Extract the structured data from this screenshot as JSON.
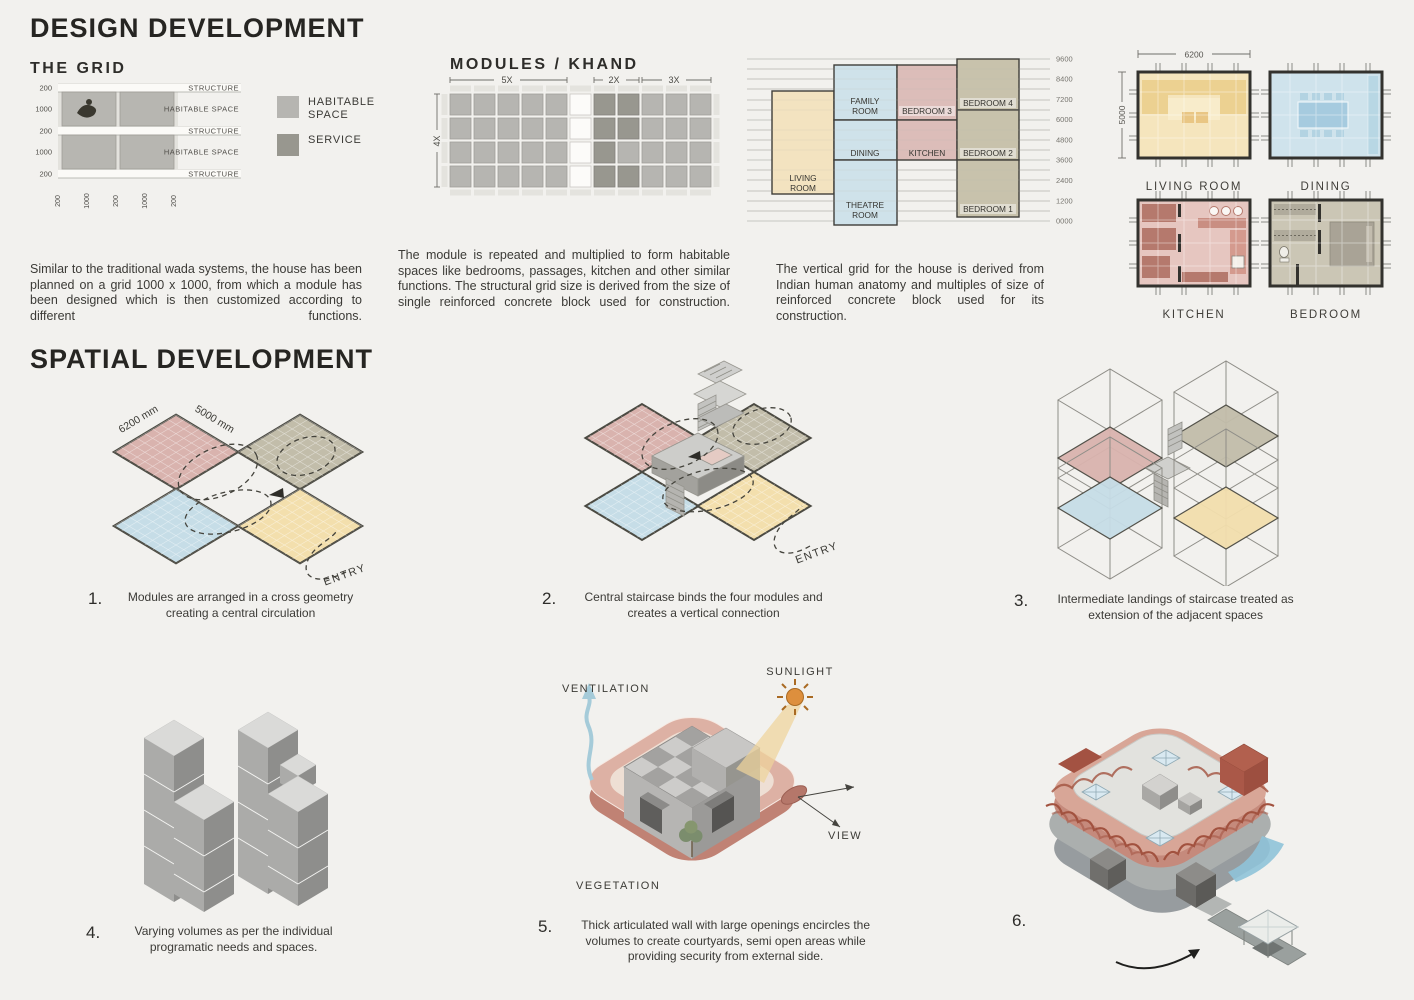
{
  "palette": {
    "module_pink": "#d9b3ae",
    "module_tan": "#c2bdaa",
    "module_blue": "#c6dde7",
    "module_yellow": "#f3dfad",
    "habitable_gray": "#b6b5b1",
    "service_gray": "#98978f",
    "wall_pink": "#d8a697",
    "section_cream": "#f3e3c0",
    "lattice_red": "#a2523f"
  },
  "header": {
    "title": "DESIGN DEVELOPMENT"
  },
  "grid": {
    "title": "THE GRID",
    "left_labels": [
      "200",
      "1000",
      "200",
      "1000",
      "200"
    ],
    "right_labels": [
      "STRUCTURE",
      "HABITABLE SPACE",
      "STRUCTURE",
      "HABITABLE SPACE",
      "STRUCTURE"
    ],
    "bottom_labels": [
      "200",
      "1000",
      "200",
      "1000",
      "200"
    ]
  },
  "legend": {
    "items": [
      {
        "label": "HABITABLE SPACE"
      },
      {
        "label": "SERVICE"
      }
    ]
  },
  "modules": {
    "title": "MODULES / KHAND",
    "dim_top": [
      "5X",
      "2X",
      "3X"
    ],
    "dim_left": "4X"
  },
  "section": {
    "scale": [
      "9600",
      "8400",
      "7200",
      "6000",
      "4800",
      "3600",
      "2400",
      "1200",
      "0000"
    ],
    "rooms": {
      "living": [
        "LIVING",
        "ROOM"
      ],
      "family": [
        "FAMILY",
        "ROOM"
      ],
      "dining": "DINING",
      "theatre": [
        "THEATRE",
        "ROOM"
      ],
      "bedroom3": "BEDROOM 3",
      "kitchen": "KITCHEN",
      "bedroom4": "BEDROOM 4",
      "bedroom2": "BEDROOM 2",
      "bedroom1": "BEDROOM 1"
    }
  },
  "plans": {
    "dim_width": "6200",
    "dim_height": "5000",
    "names": [
      "LIVING ROOM",
      "DINING",
      "KITCHEN",
      "BEDROOM"
    ]
  },
  "paragraphs": {
    "p1": "Similar to the traditional wada systems, the house has been planned on a grid 1000 x 1000, from which a module has been designed which is then customized according to different functions.",
    "p2": "The module is repeated and multiplied to form habitable spaces like bedrooms, passages, kitchen and other similar functions. The structural grid size is derived from the size of single reinforced concrete block used for construction.",
    "p3": "The vertical grid for the house is derived from Indian human anatomy and multiples of size of reinforced concrete block used for its construction."
  },
  "spatial": {
    "title": "SPATIAL DEVELOPMENT",
    "step1": {
      "num": "1.",
      "caption": "Modules are arranged in a cross geometry creating a central circulation",
      "dim1": "6200 mm",
      "dim2": "5000 mm",
      "entry": "ENTRY"
    },
    "step2": {
      "num": "2.",
      "caption": "Central staircase binds the four modules and creates a vertical connection",
      "entry": "ENTRY"
    },
    "step3": {
      "num": "3.",
      "caption": "Intermediate landings of staircase treated as extension of the adjacent spaces"
    },
    "step4": {
      "num": "4.",
      "caption": "Varying volumes as per the individual programatic needs and spaces."
    },
    "step5": {
      "num": "5.",
      "caption": "Thick articulated wall with large openings encircles the volumes to create courtyards, semi open areas while providing security from external side.",
      "labels": {
        "ventilation": "VENTILATION",
        "sunlight": "SUNLIGHT",
        "view": "VIEW",
        "vegetation": "VEGETATION"
      }
    },
    "step6": {
      "num": "6."
    }
  }
}
